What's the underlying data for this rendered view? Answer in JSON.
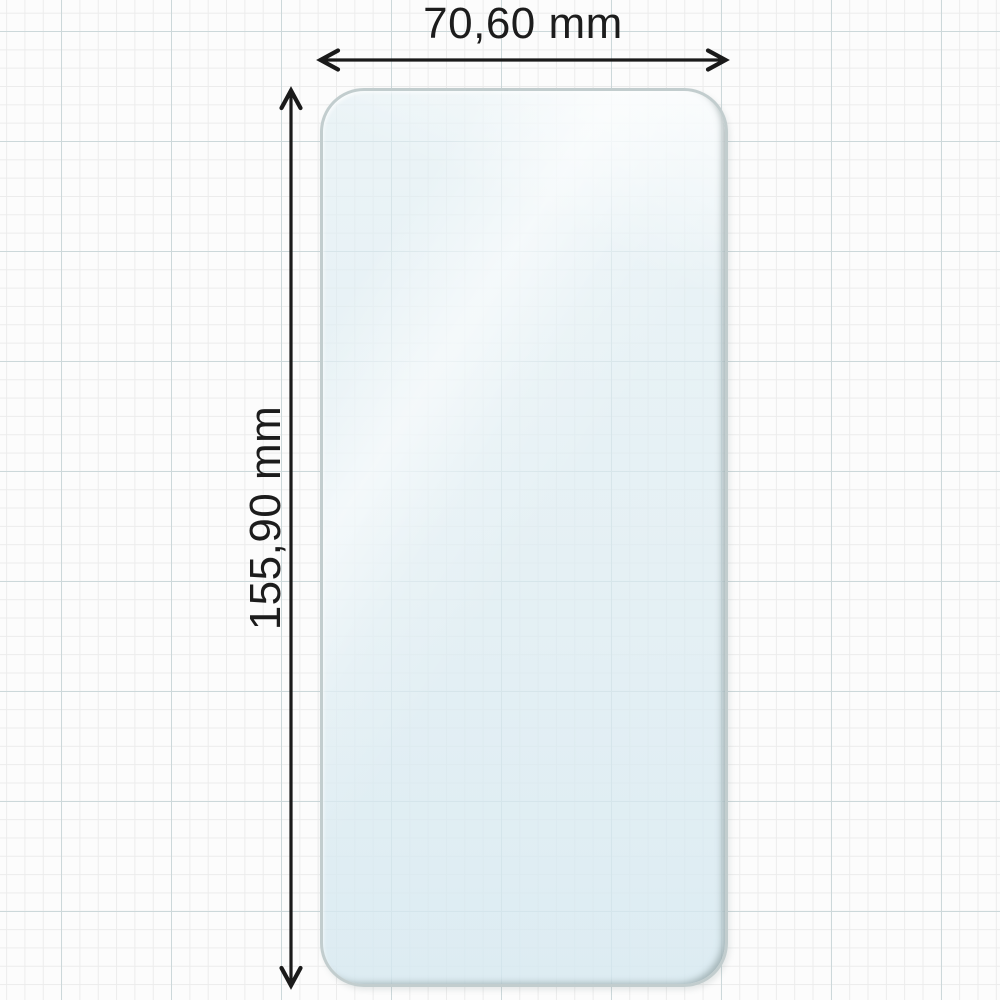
{
  "diagram": {
    "type": "product-dimension-diagram",
    "subject": "phone screen protector film on graph paper",
    "width_label": "70,60 mm",
    "height_label": "155,90 mm"
  },
  "colors": {
    "annotation_text": "#1c1c1c",
    "arrow": "#1a1a1a",
    "film_fill": "#e3eef3",
    "film_border": "#c2cdce",
    "grid_minor": "#ececec",
    "grid_major": "#ccd8da",
    "background": "#fcfcfc"
  }
}
